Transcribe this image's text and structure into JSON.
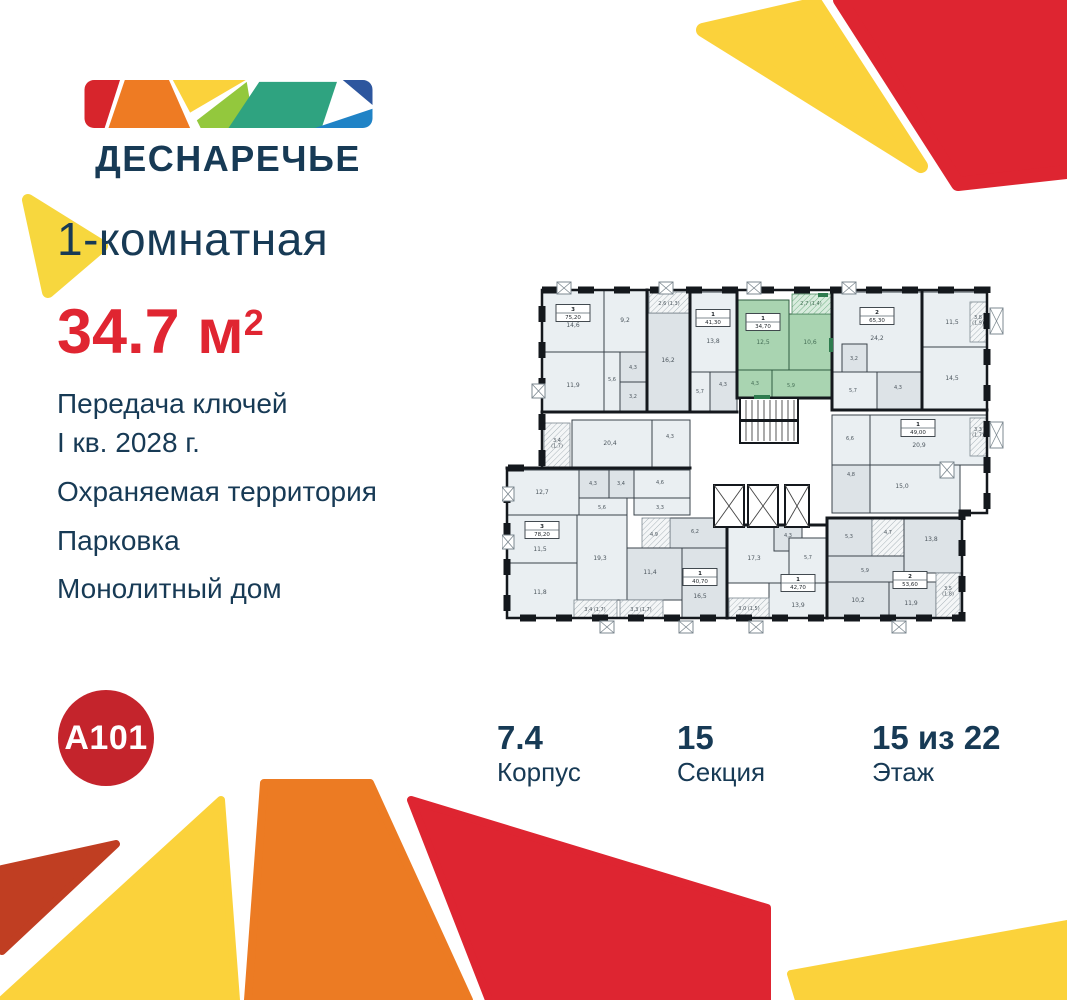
{
  "brand": {
    "wordmark": "ДЕСНАРЕЧЬЕ",
    "developer": "A101",
    "palette": {
      "navy": "#173a55",
      "accent_red": "#e02531",
      "circle_red": "#c4242c",
      "logo_red": "#d7252c",
      "logo_orange": "#ee7b23",
      "logo_yellow": "#fbd23b",
      "logo_lightgreen": "#93c83d",
      "logo_green": "#2fa380",
      "logo_darkblue": "#2d569e",
      "logo_blue": "#2083c6",
      "deco_brick": "#c03e22",
      "plan_highlight_green": "#a9d4b1"
    }
  },
  "listing": {
    "type_title": "1-комнатная",
    "area_value": "34.7",
    "area_unit": "м",
    "area_sup": "2"
  },
  "features": {
    "f1a": "Передача ключей",
    "f1b": "I кв. 2028 г.",
    "f2": "Охраняемая территория",
    "f3": "Парковка",
    "f4": "Монолитный дом"
  },
  "stats": [
    {
      "value": "7.4",
      "label": "Корпус"
    },
    {
      "value": "15",
      "label": "Секция"
    },
    {
      "value": "15 из 22",
      "label": "Этаж"
    }
  ],
  "plan": {
    "outline": "40,10 485,10 485,233 460,233 460,338 5,338 5,188 40,188",
    "rects": [
      {
        "x": 40,
        "y": 10,
        "w": 62,
        "h": 62,
        "f": "a"
      },
      {
        "x": 102,
        "y": 10,
        "w": 43,
        "h": 62,
        "f": "a"
      },
      {
        "x": 40,
        "y": 72,
        "w": 62,
        "h": 60,
        "f": "a"
      },
      {
        "x": 102,
        "y": 72,
        "w": 16,
        "h": 60,
        "f": "a"
      },
      {
        "x": 118,
        "y": 72,
        "w": 27,
        "h": 30,
        "f": "b"
      },
      {
        "x": 118,
        "y": 102,
        "w": 27,
        "h": 30,
        "f": "b"
      },
      {
        "x": 145,
        "y": 33,
        "w": 43,
        "h": 99,
        "f": "b"
      },
      {
        "x": 147,
        "y": 12,
        "w": 40,
        "h": 21,
        "f": "h"
      },
      {
        "x": 188,
        "y": 12,
        "w": 47,
        "h": 80,
        "f": "a"
      },
      {
        "x": 188,
        "y": 92,
        "w": 20,
        "h": 40,
        "f": "a"
      },
      {
        "x": 208,
        "y": 92,
        "w": 27,
        "h": 40,
        "f": "b"
      },
      {
        "x": 235,
        "y": 20,
        "w": 52,
        "h": 70,
        "f": "g"
      },
      {
        "x": 287,
        "y": 34,
        "w": 43,
        "h": 56,
        "f": "g"
      },
      {
        "x": 290,
        "y": 14,
        "w": 40,
        "h": 20,
        "f": "gh"
      },
      {
        "x": 235,
        "y": 90,
        "w": 35,
        "h": 28,
        "f": "g"
      },
      {
        "x": 270,
        "y": 90,
        "w": 60,
        "h": 28,
        "f": "g"
      },
      {
        "x": 330,
        "y": 12,
        "w": 90,
        "h": 80,
        "f": "a"
      },
      {
        "x": 420,
        "y": 12,
        "w": 65,
        "h": 55,
        "f": "a"
      },
      {
        "x": 420,
        "y": 67,
        "w": 65,
        "h": 63,
        "f": "a"
      },
      {
        "x": 340,
        "y": 64,
        "w": 25,
        "h": 28,
        "f": "b"
      },
      {
        "x": 330,
        "y": 92,
        "w": 45,
        "h": 38,
        "f": "a"
      },
      {
        "x": 375,
        "y": 92,
        "w": 45,
        "h": 38,
        "f": "b"
      },
      {
        "x": 468,
        "y": 22,
        "w": 17,
        "h": 40,
        "f": "h"
      },
      {
        "x": 330,
        "y": 135,
        "w": 38,
        "h": 50,
        "f": "a"
      },
      {
        "x": 368,
        "y": 135,
        "w": 117,
        "h": 50,
        "f": "a"
      },
      {
        "x": 330,
        "y": 185,
        "w": 38,
        "h": 48,
        "f": "b"
      },
      {
        "x": 368,
        "y": 185,
        "w": 90,
        "h": 48,
        "f": "a"
      },
      {
        "x": 468,
        "y": 138,
        "w": 17,
        "h": 38,
        "f": "h"
      },
      {
        "x": 325,
        "y": 238,
        "w": 45,
        "h": 38,
        "f": "b"
      },
      {
        "x": 370,
        "y": 238,
        "w": 32,
        "h": 38,
        "f": "h"
      },
      {
        "x": 402,
        "y": 238,
        "w": 58,
        "h": 55,
        "f": "b"
      },
      {
        "x": 325,
        "y": 276,
        "w": 77,
        "h": 26,
        "f": "b"
      },
      {
        "x": 325,
        "y": 302,
        "w": 62,
        "h": 36,
        "f": "b"
      },
      {
        "x": 387,
        "y": 302,
        "w": 47,
        "h": 36,
        "f": "b"
      },
      {
        "x": 434,
        "y": 293,
        "w": 24,
        "h": 45,
        "f": "h"
      },
      {
        "x": 225,
        "y": 245,
        "w": 62,
        "h": 58,
        "f": "a"
      },
      {
        "x": 272,
        "y": 245,
        "w": 28,
        "h": 26,
        "f": "b"
      },
      {
        "x": 287,
        "y": 258,
        "w": 38,
        "h": 45,
        "f": "a"
      },
      {
        "x": 267,
        "y": 303,
        "w": 58,
        "h": 35,
        "f": "a"
      },
      {
        "x": 227,
        "y": 318,
        "w": 40,
        "h": 20,
        "f": "h"
      },
      {
        "x": 168,
        "y": 238,
        "w": 57,
        "h": 30,
        "f": "b"
      },
      {
        "x": 140,
        "y": 238,
        "w": 28,
        "h": 40,
        "f": "h"
      },
      {
        "x": 125,
        "y": 268,
        "w": 55,
        "h": 52,
        "f": "b"
      },
      {
        "x": 180,
        "y": 268,
        "w": 45,
        "h": 70,
        "f": "b"
      },
      {
        "x": 70,
        "y": 140,
        "w": 80,
        "h": 48,
        "f": "a"
      },
      {
        "x": 150,
        "y": 140,
        "w": 38,
        "h": 48,
        "f": "a"
      },
      {
        "x": 42,
        "y": 143,
        "w": 26,
        "h": 46,
        "f": "h"
      },
      {
        "x": 5,
        "y": 190,
        "w": 72,
        "h": 45,
        "f": "a"
      },
      {
        "x": 77,
        "y": 190,
        "w": 30,
        "h": 28,
        "f": "b"
      },
      {
        "x": 107,
        "y": 190,
        "w": 25,
        "h": 28,
        "f": "b"
      },
      {
        "x": 132,
        "y": 190,
        "w": 56,
        "h": 28,
        "f": "a"
      },
      {
        "x": 77,
        "y": 218,
        "w": 48,
        "h": 17,
        "f": "a"
      },
      {
        "x": 132,
        "y": 218,
        "w": 56,
        "h": 17,
        "f": "a"
      },
      {
        "x": 5,
        "y": 235,
        "w": 70,
        "h": 48,
        "f": "a"
      },
      {
        "x": 75,
        "y": 235,
        "w": 50,
        "h": 85,
        "f": "a"
      },
      {
        "x": 5,
        "y": 283,
        "w": 70,
        "h": 55,
        "f": "a"
      },
      {
        "x": 72,
        "y": 320,
        "w": 43,
        "h": 18,
        "f": "h"
      },
      {
        "x": 118,
        "y": 320,
        "w": 43,
        "h": 18,
        "f": "h"
      }
    ],
    "walls": [
      [
        145,
        10,
        145,
        132
      ],
      [
        188,
        12,
        188,
        132
      ],
      [
        235,
        12,
        235,
        118
      ],
      [
        330,
        12,
        330,
        130
      ],
      [
        420,
        12,
        420,
        130
      ],
      [
        330,
        130,
        485,
        130
      ],
      [
        40,
        132,
        235,
        132
      ],
      [
        235,
        118,
        330,
        118
      ],
      [
        5,
        188,
        188,
        188
      ],
      [
        325,
        238,
        460,
        238
      ],
      [
        325,
        238,
        325,
        338
      ],
      [
        225,
        245,
        225,
        338
      ],
      [
        225,
        245,
        325,
        245
      ]
    ],
    "stairs": {
      "x": 238,
      "y": 118,
      "w": 58,
      "h": 45
    },
    "lifts": [
      {
        "x": 212,
        "y": 205,
        "w": 30,
        "h": 42
      },
      {
        "x": 246,
        "y": 205,
        "w": 30,
        "h": 42
      },
      {
        "x": 283,
        "y": 205,
        "w": 24,
        "h": 42
      }
    ],
    "xboxes": [
      {
        "x": 55,
        "y": 2,
        "w": 14,
        "h": 12
      },
      {
        "x": 157,
        "y": 2,
        "w": 14,
        "h": 12
      },
      {
        "x": 245,
        "y": 2,
        "w": 14,
        "h": 12
      },
      {
        "x": 340,
        "y": 2,
        "w": 14,
        "h": 12
      },
      {
        "x": 30,
        "y": 104,
        "w": 13,
        "h": 14
      },
      {
        "x": 0,
        "y": 207,
        "w": 12,
        "h": 14
      },
      {
        "x": 0,
        "y": 255,
        "w": 12,
        "h": 14
      },
      {
        "x": 98,
        "y": 341,
        "w": 14,
        "h": 12
      },
      {
        "x": 177,
        "y": 341,
        "w": 14,
        "h": 12
      },
      {
        "x": 247,
        "y": 341,
        "w": 14,
        "h": 12
      },
      {
        "x": 390,
        "y": 341,
        "w": 14,
        "h": 12
      },
      {
        "x": 488,
        "y": 28,
        "w": 13,
        "h": 26
      },
      {
        "x": 488,
        "y": 142,
        "w": 13,
        "h": 26
      },
      {
        "x": 438,
        "y": 182,
        "w": 14,
        "h": 16
      }
    ],
    "marks": [
      {
        "x": 252,
        "y": 115,
        "w": 16,
        "h": 4
      },
      {
        "x": 327,
        "y": 58,
        "w": 4,
        "h": 14
      },
      {
        "x": 316,
        "y": 13,
        "w": 10,
        "h": 4
      }
    ],
    "labels": [
      {
        "t": "14,6",
        "x": 71,
        "y": 47
      },
      {
        "t": "9,2",
        "x": 123,
        "y": 42
      },
      {
        "t": "11,9",
        "x": 71,
        "y": 107
      },
      {
        "t": "5,6",
        "x": 110,
        "y": 101,
        "s": 1
      },
      {
        "t": "4,3",
        "x": 131,
        "y": 89,
        "s": 1
      },
      {
        "t": "3,2",
        "x": 131,
        "y": 118,
        "s": 1
      },
      {
        "t": "16,2",
        "x": 166,
        "y": 82
      },
      {
        "t": "2,6 (1,3)",
        "x": 167,
        "y": 25,
        "s": 1
      },
      {
        "t": "13,8",
        "x": 211,
        "y": 63
      },
      {
        "t": "5,7",
        "x": 198,
        "y": 113,
        "s": 1
      },
      {
        "t": "4,3",
        "x": 221,
        "y": 106,
        "s": 1
      },
      {
        "t": "12,5",
        "x": 261,
        "y": 64,
        "g": 1
      },
      {
        "t": "10,6",
        "x": 308,
        "y": 64,
        "g": 1
      },
      {
        "t": "2,7 (1,4)",
        "x": 309,
        "y": 25,
        "s": 1,
        "g": 1
      },
      {
        "t": "4,3",
        "x": 253,
        "y": 105,
        "s": 1,
        "g": 1
      },
      {
        "t": "5,9",
        "x": 289,
        "y": 107,
        "s": 1,
        "g": 1
      },
      {
        "t": "24,2",
        "x": 375,
        "y": 60
      },
      {
        "t": "11,5",
        "x": 450,
        "y": 44
      },
      {
        "t": "14,5",
        "x": 450,
        "y": 100
      },
      {
        "t": "3,2",
        "x": 352,
        "y": 80,
        "s": 1
      },
      {
        "t": "5,7",
        "x": 351,
        "y": 112,
        "s": 1
      },
      {
        "t": "4,3",
        "x": 396,
        "y": 109,
        "s": 1
      },
      {
        "t": "3,8|(1,9)",
        "x": 476,
        "y": 39,
        "s": 1
      },
      {
        "t": "6,6",
        "x": 348,
        "y": 160,
        "s": 1
      },
      {
        "t": "20,9",
        "x": 417,
        "y": 167
      },
      {
        "t": "3,3|(1,7)",
        "x": 476,
        "y": 151,
        "s": 1
      },
      {
        "t": "4,8",
        "x": 349,
        "y": 196,
        "s": 1
      },
      {
        "t": "15,0",
        "x": 400,
        "y": 208
      },
      {
        "t": "5,3",
        "x": 347,
        "y": 258,
        "s": 1
      },
      {
        "t": "4,7",
        "x": 386,
        "y": 254,
        "s": 1
      },
      {
        "t": "13,8",
        "x": 429,
        "y": 261
      },
      {
        "t": "5,9",
        "x": 363,
        "y": 292,
        "s": 1
      },
      {
        "t": "10,2",
        "x": 356,
        "y": 322
      },
      {
        "t": "11,9",
        "x": 409,
        "y": 325
      },
      {
        "t": "3,5|(1,8)",
        "x": 446,
        "y": 310,
        "s": 1
      },
      {
        "t": "17,3",
        "x": 252,
        "y": 280
      },
      {
        "t": "4,3",
        "x": 286,
        "y": 257,
        "s": 1
      },
      {
        "t": "5,7",
        "x": 306,
        "y": 279,
        "s": 1
      },
      {
        "t": "13,9",
        "x": 296,
        "y": 327
      },
      {
        "t": "3,0 (1,5)",
        "x": 247,
        "y": 330,
        "s": 1
      },
      {
        "t": "6,2",
        "x": 193,
        "y": 253,
        "s": 1
      },
      {
        "t": "4,9",
        "x": 152,
        "y": 256,
        "s": 1
      },
      {
        "t": "11,4",
        "x": 148,
        "y": 294
      },
      {
        "t": "16,5",
        "x": 198,
        "y": 318
      },
      {
        "t": "12,7",
        "x": 40,
        "y": 214
      },
      {
        "t": "4,3",
        "x": 91,
        "y": 205,
        "s": 1
      },
      {
        "t": "3,4",
        "x": 119,
        "y": 205,
        "s": 1
      },
      {
        "t": "4,6",
        "x": 158,
        "y": 204,
        "s": 1
      },
      {
        "t": "5,6",
        "x": 100,
        "y": 229,
        "s": 1
      },
      {
        "t": "3,3",
        "x": 158,
        "y": 229,
        "s": 1
      },
      {
        "t": "11,5",
        "x": 38,
        "y": 271
      },
      {
        "t": "19,3",
        "x": 98,
        "y": 280
      },
      {
        "t": "11,8",
        "x": 38,
        "y": 314
      },
      {
        "t": "20,4",
        "x": 108,
        "y": 165
      },
      {
        "t": "4,3",
        "x": 168,
        "y": 158,
        "s": 1
      },
      {
        "t": "3,4|(1,7)",
        "x": 55,
        "y": 162,
        "s": 1
      },
      {
        "t": "3,4 (1,7)",
        "x": 93,
        "y": 331,
        "s": 1
      },
      {
        "t": "3,3 (1,7)",
        "x": 139,
        "y": 331,
        "s": 1
      }
    ],
    "badges": [
      {
        "n": "3",
        "a": "75,20",
        "x": 71,
        "y": 33
      },
      {
        "n": "1",
        "a": "41,30",
        "x": 211,
        "y": 38
      },
      {
        "n": "1",
        "a": "34,70",
        "x": 261,
        "y": 42,
        "g": 1
      },
      {
        "n": "2",
        "a": "65,30",
        "x": 375,
        "y": 36
      },
      {
        "n": "1",
        "a": "49,00",
        "x": 416,
        "y": 148
      },
      {
        "n": "2",
        "a": "53,60",
        "x": 408,
        "y": 300
      },
      {
        "n": "1",
        "a": "42,70",
        "x": 296,
        "y": 303
      },
      {
        "n": "1",
        "a": "40,70",
        "x": 198,
        "y": 297
      },
      {
        "n": "3",
        "a": "78,20",
        "x": 40,
        "y": 250
      }
    ]
  }
}
